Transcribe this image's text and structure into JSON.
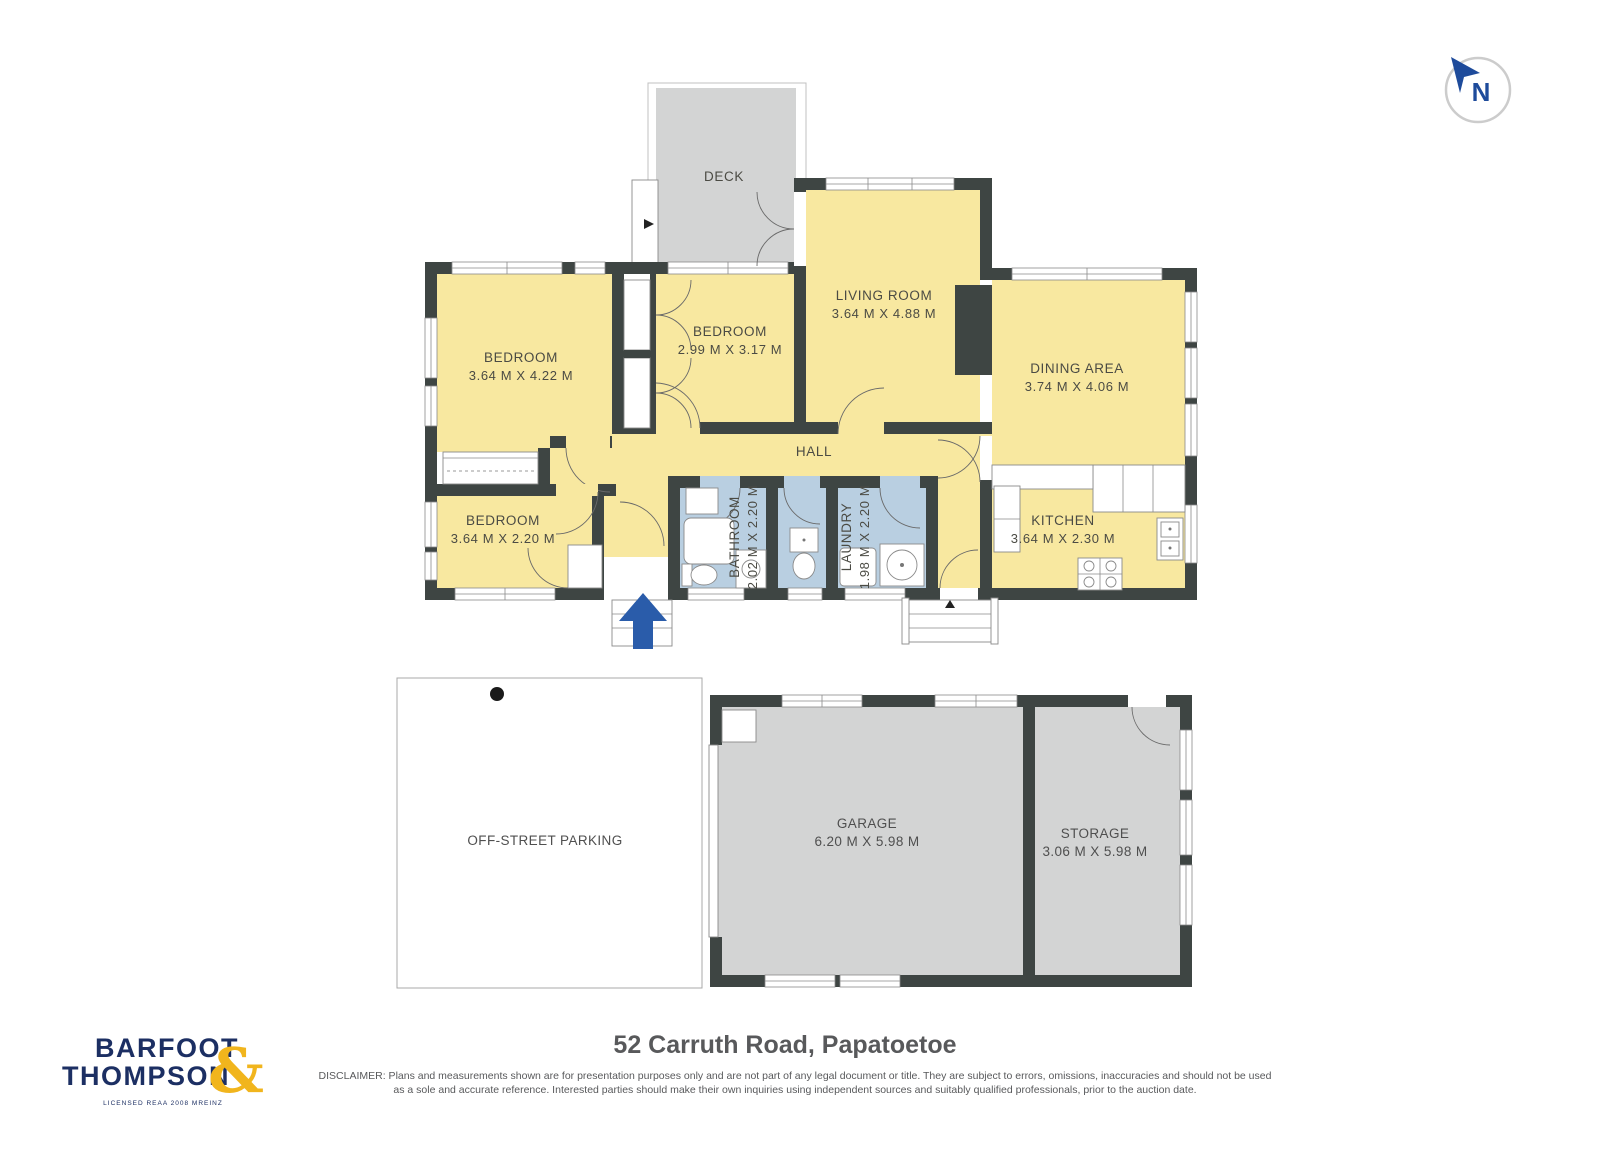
{
  "compass": {
    "label": "N"
  },
  "plan": {
    "deck": {
      "name": "DECK"
    },
    "living": {
      "name": "LIVING ROOM",
      "dims": "3.64 M X 4.88 M"
    },
    "dining": {
      "name": "DINING AREA",
      "dims": "3.74 M X 4.06 M"
    },
    "kitchen": {
      "name": "KITCHEN",
      "dims": "3.64 M X 2.30 M"
    },
    "bedroom_front": {
      "name": "BEDROOM",
      "dims": "2.99 M X 3.17 M"
    },
    "bedroom_main": {
      "name": "BEDROOM",
      "dims": "3.64 M X 4.22 M"
    },
    "bedroom_small": {
      "name": "BEDROOM",
      "dims": "3.64 M X 2.20 M"
    },
    "hall": {
      "name": "HALL"
    },
    "bathroom": {
      "name": "BATHROOM",
      "dims": "2.02 M X 2.20 M"
    },
    "laundry": {
      "name": "LAUNDRY",
      "dims": "1.98 M X 2.20 M"
    },
    "parking": {
      "name": "OFF-STREET PARKING"
    },
    "garage": {
      "name": "GARAGE",
      "dims": "6.20 M X 5.98 M"
    },
    "storage": {
      "name": "STORAGE",
      "dims": "3.06 M X 5.98 M"
    }
  },
  "footer": {
    "brand_top": "BARFOOT",
    "brand_bottom": "THOMPSON",
    "brand_amp": "&",
    "brand_sub": "LICENSED REAA 2008 MREINZ",
    "address": "52 Carruth Road, Papatoetoe",
    "disclaimer_line1": "DISCLAIMER: Plans and measurements shown are for presentation purposes only and are not part of any legal document or title. They are subject to errors, omissions, inaccuracies and should not be used",
    "disclaimer_line2": "as a sole and accurate reference. Interested parties should make their own inquiries using independent sources and suitably qualified professionals, prior to the auction date."
  },
  "colors": {
    "wall": "#3E4543",
    "room_fill": "#F8E8A0",
    "wet_room_fill": "#B9CFE1",
    "outdoor_fill": "#D3D4D4",
    "entry_arrow": "#2A5CAA",
    "compass_blue": "#1E4B9B",
    "brand_navy": "#1C2F63",
    "brand_gold": "#F1B51D",
    "label_text": "#4B4B44",
    "footer_text": "#58595B"
  }
}
